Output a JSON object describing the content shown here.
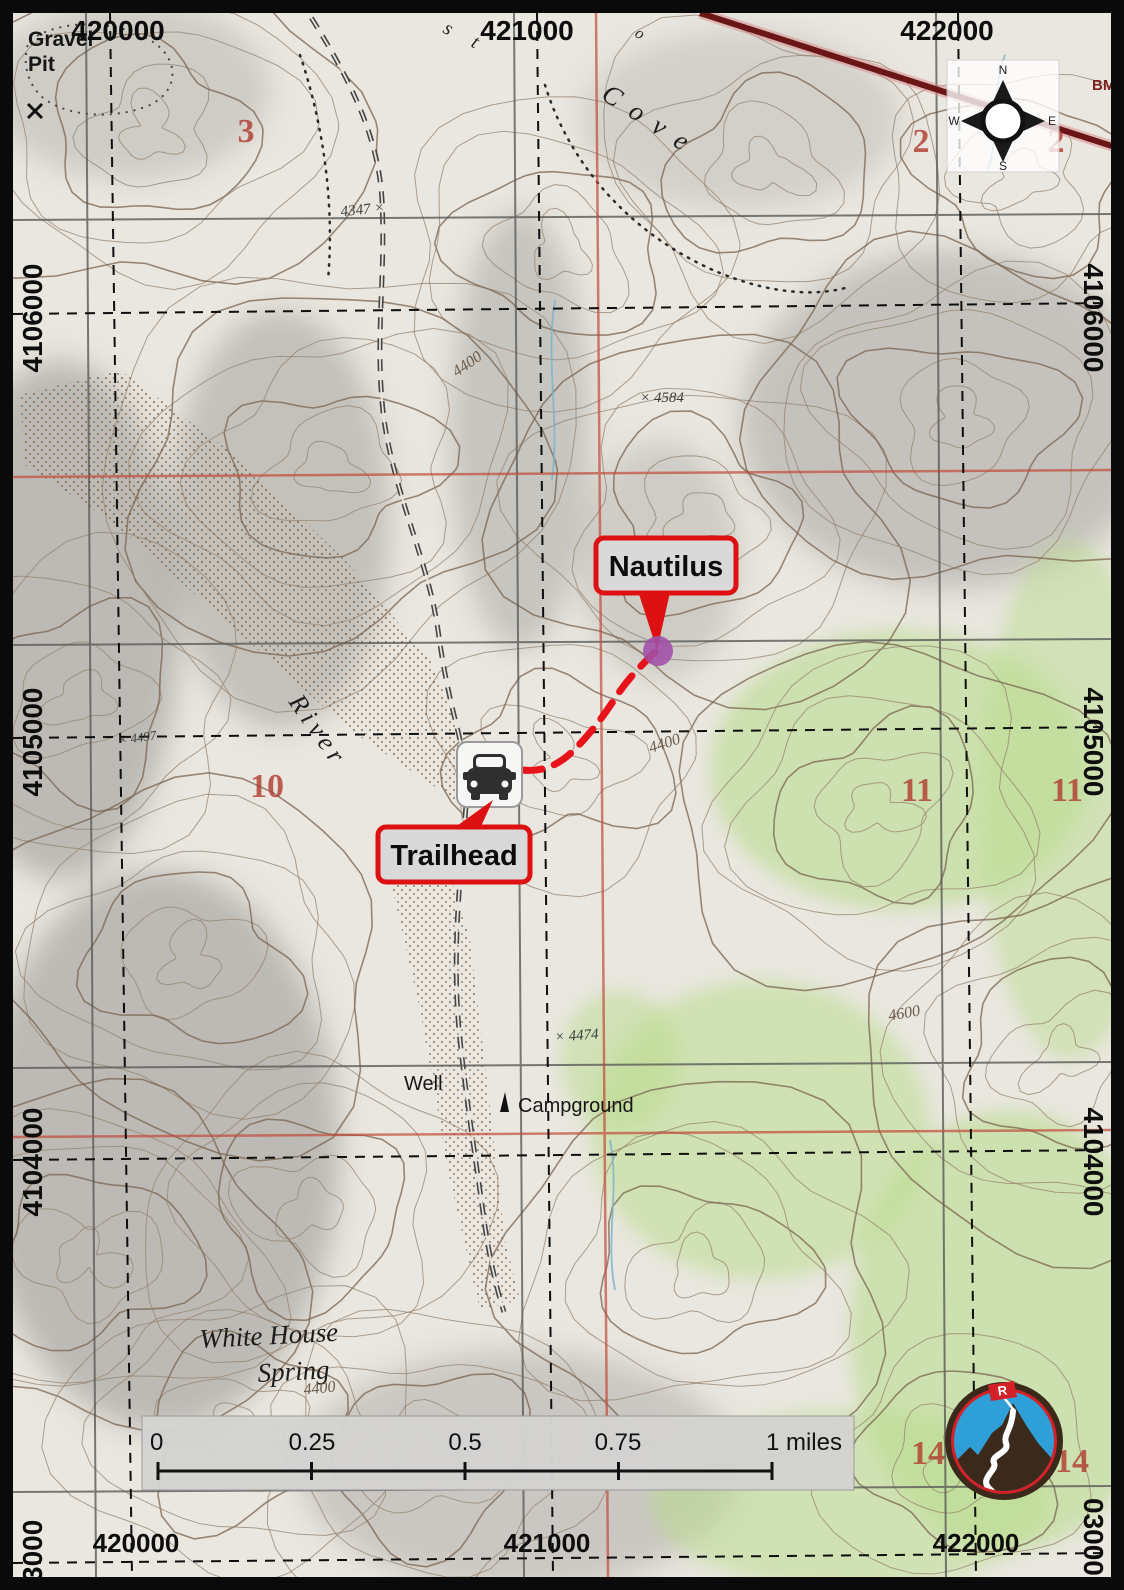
{
  "grid": {
    "eastings_top": [
      "420000",
      "421000",
      "422000"
    ],
    "eastings_bottom": [
      "420000",
      "421000",
      "422000"
    ],
    "northings_left": [
      "4106000",
      "4105000",
      "4104000"
    ],
    "northings_right": [
      "4106000",
      "4105000",
      "4104000"
    ],
    "partial_northing_left": "3000",
    "partial_northing_right": "03000"
  },
  "compass": {
    "north": "N",
    "east": "E",
    "south": "S",
    "west": "W"
  },
  "callouts": {
    "nautilus": "Nautilus",
    "trailhead": "Trailhead"
  },
  "scale_bar": {
    "tick_labels": [
      "0",
      "0.25",
      "0.5",
      "0.75"
    ],
    "end_label": "1 miles"
  },
  "places": {
    "gravel_pit_line1": "Gravel",
    "gravel_pit_line2": "Pit",
    "cove": "Cove",
    "fragment_s": "s",
    "fragment_t": "t",
    "fragment_o": "o",
    "river": "River",
    "well": "Well",
    "campground": "Campground",
    "spring_line1": "White House",
    "spring_line2": "Spring",
    "benchmark": "BM"
  },
  "elevation_points": [
    "4347 ×",
    "× 4584",
    "× 4474",
    "× 4497"
  ],
  "contour_labels": [
    "4400",
    "4400",
    "4600",
    "4400"
  ],
  "section_numbers": [
    "3",
    "2",
    "2",
    "10",
    "11",
    "11",
    "14",
    "14"
  ],
  "logo": {
    "flag_letter": "R"
  },
  "colors": {
    "trail_red": "#e8131a",
    "callout_border": "#dd1111",
    "callout_bg": "#d9d9d9",
    "marker_purple": "#a14fa8",
    "section_red": "#b03a2e",
    "vegetation_green": "#b9dc8e",
    "logo_blue": "#2f9fd8",
    "logo_brown": "#3b2a1c",
    "logo_red": "#d42027",
    "grid_red": "#c14a3a"
  }
}
